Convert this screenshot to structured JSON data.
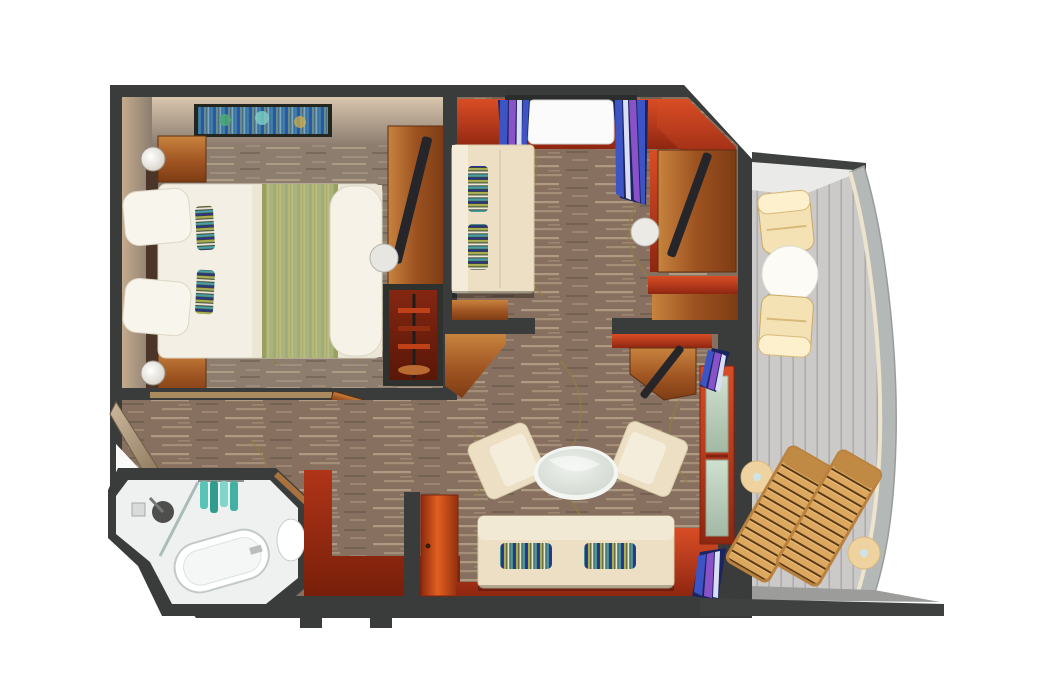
{
  "canvas": {
    "width": 1048,
    "height": 699
  },
  "colors": {
    "wall": "#3a3c3b",
    "floor_bedroom": "#8c7d6f",
    "floor_main": "#87705f",
    "floor_streak": "#cdbb9c",
    "vine": "#8f7f45",
    "bed_linen": "#f3efe4",
    "bed_runner": "#b4b979",
    "cream_sofa": "#ecdfc4",
    "towel_teal": "#43b0a4",
    "curtain_blue": "#3d55c4",
    "curtain_purple": "#8a52c9",
    "curtain_dark": "#1b2460",
    "fixture_white": "#ffffff",
    "bathroom_floor": "#eef1f0",
    "balcony_deck": "#cbcac8",
    "deck_line": "#a9a8a6",
    "railing": "#b4b8b6",
    "railing_cream": "#ece4cd",
    "lounger_wood": "#dca75f",
    "balcony_cream": "#f4e2b4",
    "table_white": "#fbfaf5",
    "red_accent": "#c14327",
    "wood_mid": "#b06328"
  },
  "scene": {
    "type": "cruise-ship-suite-floorplan",
    "rooms": [
      {
        "name": "bedroom",
        "furniture": [
          "queen-bed",
          "pillows",
          "accent-pillows",
          "nightstand-left-top",
          "nightstand-left-bottom",
          "bedside-lamps",
          "wall-art",
          "desk",
          "tv",
          "stool",
          "wardrobe-with-hangers"
        ]
      },
      {
        "name": "sitting-room",
        "furniture": [
          "sofa-bed",
          "striped-pillows",
          "window",
          "curtains",
          "desk",
          "tv",
          "stool",
          "minibar-cabinet"
        ]
      },
      {
        "name": "living-room",
        "furniture": [
          "sofa",
          "armchair-left",
          "armchair-right",
          "oval-coffee-table",
          "tv-cabinet",
          "balcony-door",
          "curtains",
          "entry-door"
        ]
      },
      {
        "name": "bathroom",
        "furniture": [
          "bathtub",
          "shower-head",
          "glass-partition",
          "sink",
          "towels"
        ]
      },
      {
        "name": "corridor",
        "furniture": [
          "closet-sliding-door",
          "wood-threshold",
          "open-door"
        ]
      },
      {
        "name": "balcony",
        "furniture": [
          "lounge-chair-top",
          "lounge-chair-bottom",
          "round-table",
          "sun-lounger-1",
          "sun-lounger-2",
          "side-table-1",
          "side-table-2",
          "curved-railing"
        ]
      }
    ]
  }
}
